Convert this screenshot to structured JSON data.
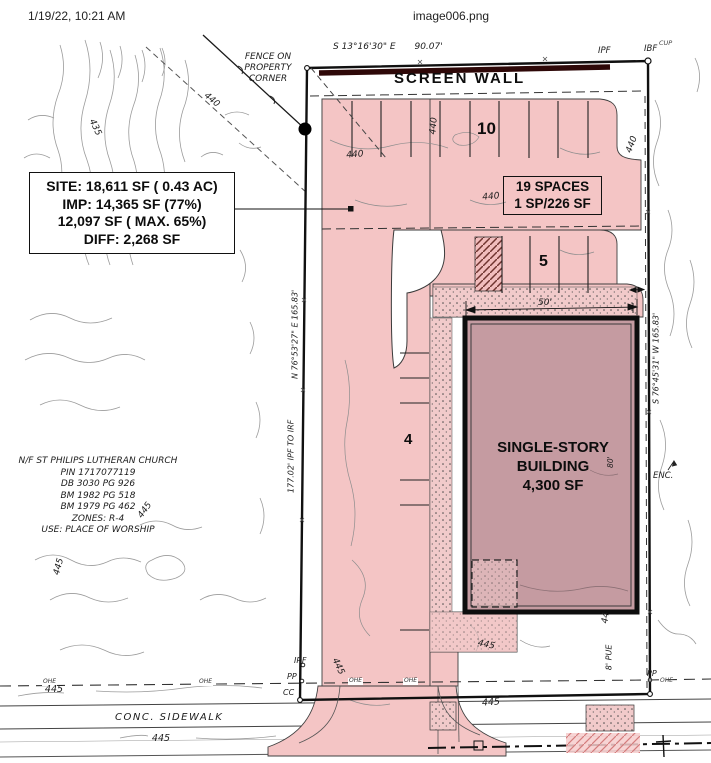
{
  "header": {
    "timestamp": "1/19/22, 10:21 AM",
    "filename": "image006.png"
  },
  "site_data_box": {
    "lines": [
      "SITE: 18,611 SF ( 0.43 AC)",
      "IMP: 14,365 SF (77%)",
      "12,097 SF ( MAX. 65%)",
      "DIFF: 2,268 SF"
    ]
  },
  "parking_box": {
    "lines": [
      "19 SPACES",
      "1 SP/226 SF"
    ]
  },
  "building": {
    "lines": [
      "SINGLE-STORY",
      "BUILDING",
      "4,300 SF"
    ]
  },
  "labels": {
    "screen_wall": "SCREEN WALL",
    "fence_note": [
      "FENCE ON",
      "PROPERTY",
      "CORNER"
    ],
    "conc_sidewalk": "CONC. SIDEWALK",
    "pue": "8' PUE",
    "enc": "ENC.",
    "space_count_top": "10",
    "space_count_east": "5",
    "space_count_west": "4",
    "dim_building_width": "50'",
    "dim_building_depth": "80'"
  },
  "bearings": {
    "north_line": "S 13°16'30\" E",
    "north_distance": "90.07'",
    "west_line": "N 76°53'27\" E  165.83'",
    "west_tie": "177.02' IPF TO IRF",
    "east_line": "S 76°45'31\" W  165.83'"
  },
  "monuments": {
    "ipf": "IPF",
    "ibf": "IBF",
    "cup": "CUP",
    "irf": "IRF",
    "pp": "PP",
    "cc": "CC",
    "ohe": "OHE"
  },
  "adjacent_owner": {
    "lines": [
      "N/F ST PHILIPS LUTHERAN CHURCH",
      "PIN 1717077119",
      "DB 3030 PG 926",
      "BM 1982 PG 518",
      "BM 1979 PG 462",
      "ZONES: R-4",
      "USE: PLACE OF WORSHIP"
    ]
  },
  "contours": {
    "c435": "435",
    "c440": "440",
    "c445": "445",
    "c44": "44"
  }
}
